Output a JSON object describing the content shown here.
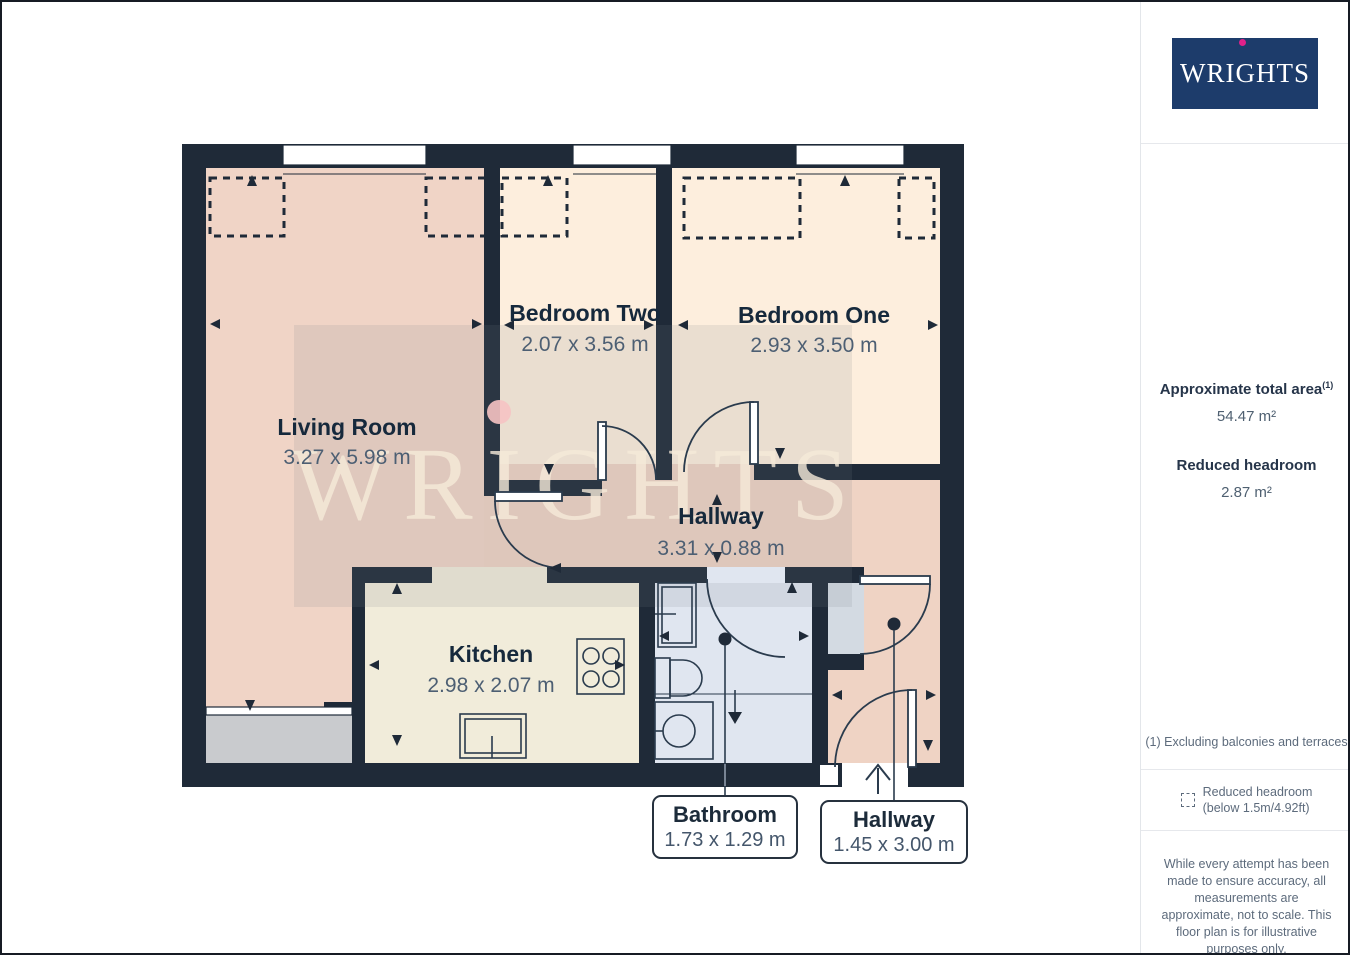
{
  "sidebar": {
    "logo": "WRIGHTS",
    "area_label": "Approximate total area",
    "area_superscript": "(1)",
    "area_value": "54.47 m²",
    "headroom_label": "Reduced headroom",
    "headroom_value": "2.87 m²",
    "footnote": "(1) Excluding balconies and terraces",
    "legend_label": "Reduced headroom",
    "legend_sublabel": "(below 1.5m/4.92ft)",
    "disclaimer": "While every attempt has been made to ensure accuracy, all measurements are approximate, not to scale. This floor plan is for illustrative purposes only.",
    "brand_footer_normal": "GIRAFFE",
    "brand_footer_bold": "360"
  },
  "floorplan": {
    "watermark": "WRIGHTS",
    "rooms": [
      {
        "name": "Living Room",
        "dims": "3.27 x 5.98 m"
      },
      {
        "name": "Bedroom Two",
        "dims": "2.07 x 3.56 m"
      },
      {
        "name": "Bedroom One",
        "dims": "2.93 x 3.50 m"
      },
      {
        "name": "Hallway",
        "dims": "3.31 x 0.88 m"
      },
      {
        "name": "Kitchen",
        "dims": "2.98 x 2.07 m"
      }
    ],
    "callouts": [
      {
        "name": "Bathroom",
        "dims": "1.73 x 1.29 m"
      },
      {
        "name": "Hallway",
        "dims": "1.45 x 3.00 m"
      }
    ],
    "colors": {
      "wall": "#1f2a38",
      "living_room": "#f0d4c6",
      "bedroom": "#fdeedd",
      "kitchen": "#f1ecda",
      "bathroom": "#e0e6f0",
      "balcony": "#c9cbce",
      "closet": "#d3dae2",
      "watermark_text": "#f6ebd9",
      "watermark_dot": "#f6c3c3",
      "logo_navy": "#1d3c6b",
      "logo_dot_magenta": "#e0218a"
    }
  }
}
